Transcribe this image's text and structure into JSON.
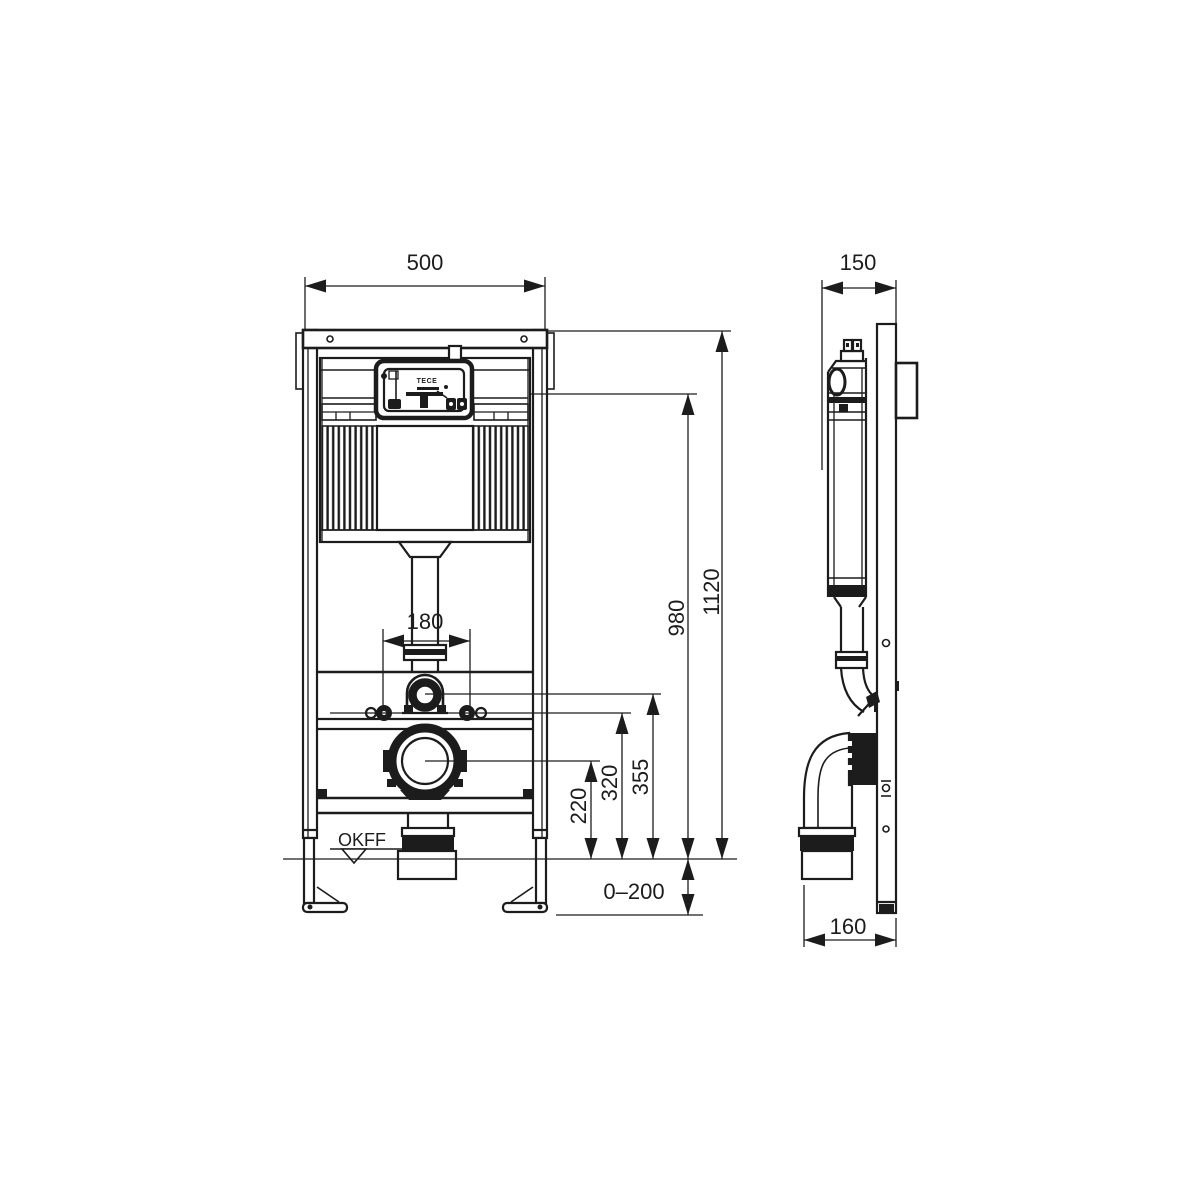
{
  "colors": {
    "line": "#1c1c1c",
    "background": "#ffffff"
  },
  "front_view": {
    "dims": {
      "width": "500",
      "height": "1120",
      "flush_unit_height": "980",
      "water_inlet_height": "355",
      "bolt_height": "320",
      "outlet_height": "220",
      "bolt_spacing": "180",
      "floor_adjust_range": "0–200",
      "floor_level_label": "OKFF"
    },
    "cistern_logo": "TECE"
  },
  "side_view": {
    "dims": {
      "depth": "150",
      "outlet_depth": "160"
    }
  }
}
